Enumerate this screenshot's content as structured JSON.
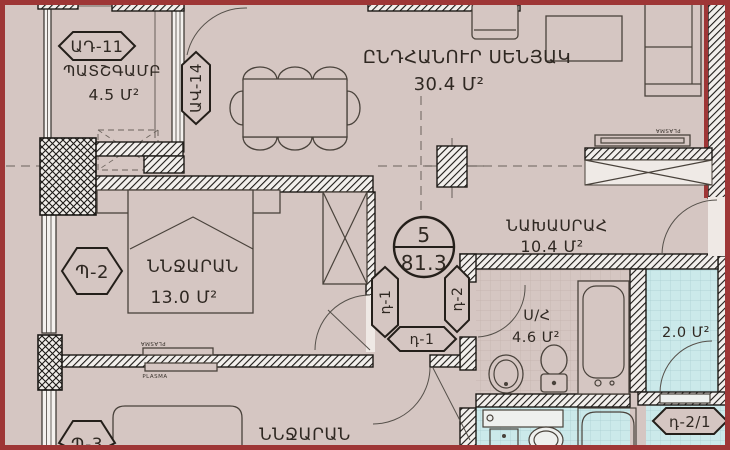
{
  "badge": {
    "number": "5",
    "total_area": "81.3"
  },
  "rooms": {
    "balcony": {
      "name": "ՊԱՏՇԳԱՄԲ",
      "area": "4.5 Մ²"
    },
    "living": {
      "name": "ԸՆԴՀԱՆՈՒՐ ՍԵՆՅԱԿ",
      "area": "30.4 Մ²"
    },
    "bedroom1": {
      "name": "ՆՆՋԱՐԱՆ",
      "area": "13.0 Մ²"
    },
    "hallway": {
      "name": "ՆԱԽԱՍՐԱՀ",
      "area": "10.4 Մ²"
    },
    "bathroom": {
      "name": "Ս/Հ",
      "area": "4.6 Մ²"
    },
    "storage": {
      "area": "2.0 Մ²"
    },
    "bedroom2": {
      "name": "ՆՆՋԱՐԱՆ"
    }
  },
  "tags": {
    "balcony_door": "ԱԴ-11",
    "balcony_window": "ԱՎ-14",
    "window_p2": "Պ-2",
    "window_p3": "Պ-3",
    "door_bedroom1": "դ-1",
    "door_bathroom": "դ-2",
    "door_bedroom2": "դ-1",
    "door_storage": "դ-2/1"
  },
  "tv_label": "PLASMA",
  "colors": {
    "floor": "#d5c6c2",
    "wet_floor": "#cbe9ea",
    "wall_ink": "#1c1916",
    "frame_red": "#9e3636"
  }
}
